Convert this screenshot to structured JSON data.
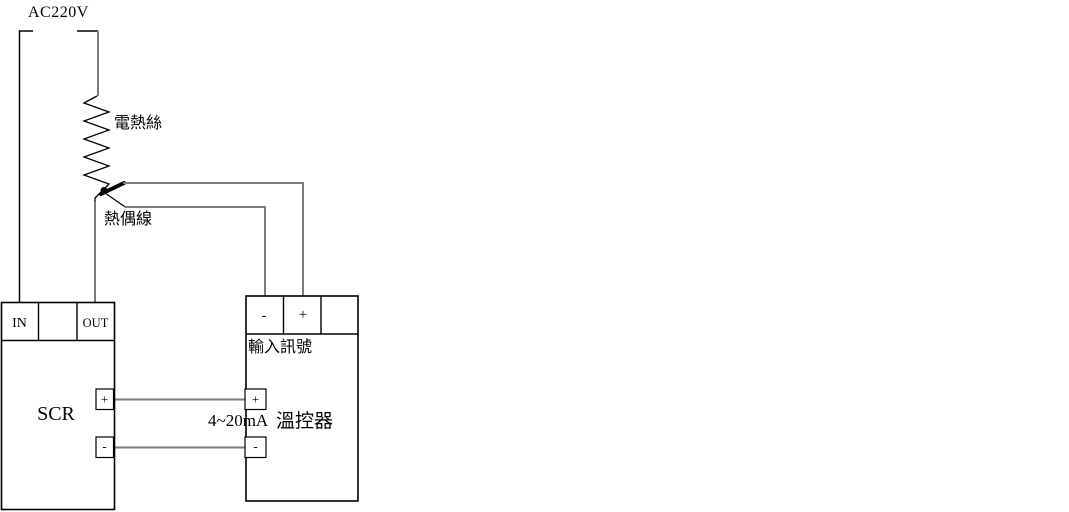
{
  "diagram": {
    "power": {
      "label": "AC220V"
    },
    "heater": {
      "label": "電熱絲"
    },
    "thermocouple": {
      "label": "熱偶線"
    },
    "scr_unit": {
      "name": "SCR",
      "terminal_in": "IN",
      "terminal_out": "OUT",
      "output_plus": "+",
      "output_minus": "-"
    },
    "controller_unit": {
      "input_minus": "-",
      "input_plus": "+",
      "input_label": "輸入訊號",
      "signal_plus": "+",
      "signal_minus": "-",
      "signal_range": "4~20mA",
      "name": "溫控器"
    },
    "colors": {
      "wire": "#7d7d7d",
      "outline": "#000000",
      "background": "#ffffff"
    }
  }
}
